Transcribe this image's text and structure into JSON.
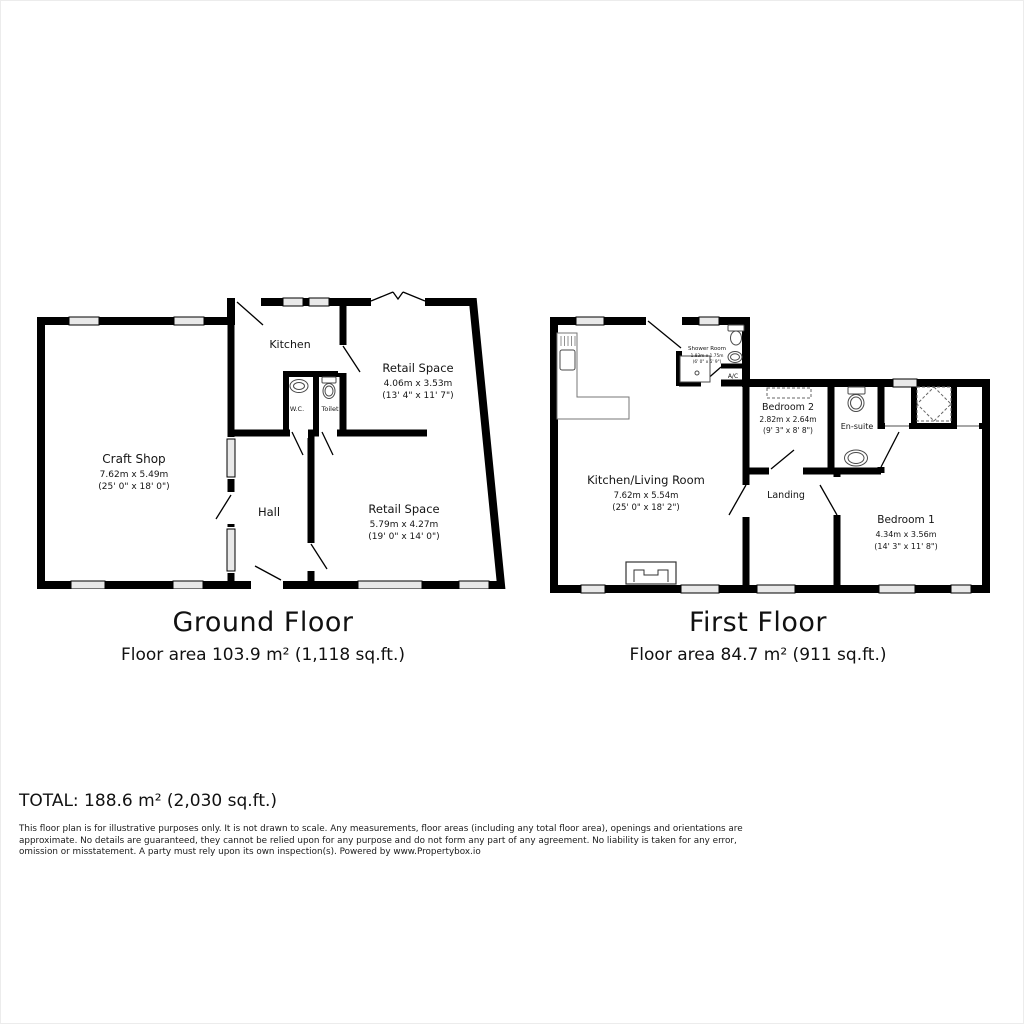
{
  "ground_floor": {
    "title": "Ground Floor",
    "area": "Floor area 103.9 m² (1,118 sq.ft.)",
    "rooms": {
      "craft_shop": {
        "name": "Craft Shop",
        "dim_m": "7.62m x 5.49m",
        "dim_ft": "(25' 0\" x 18' 0\")"
      },
      "kitchen": {
        "name": "Kitchen"
      },
      "wc": {
        "name": "W.C."
      },
      "toilet": {
        "name": "Toilet"
      },
      "retail_upper": {
        "name": "Retail Space",
        "dim_m": "4.06m x 3.53m",
        "dim_ft": "(13' 4\" x 11' 7\")"
      },
      "hall": {
        "name": "Hall"
      },
      "retail_lower": {
        "name": "Retail Space",
        "dim_m": "5.79m x 4.27m",
        "dim_ft": "(19' 0\" x 14' 0\")"
      }
    }
  },
  "first_floor": {
    "title": "First Floor",
    "area": "Floor area 84.7 m² (911 sq.ft.)",
    "rooms": {
      "kitchen_living": {
        "name": "Kitchen/Living Room",
        "dim_m": "7.62m x 5.54m",
        "dim_ft": "(25' 0\" x 18' 2\")"
      },
      "shower_room": {
        "name": "Shower Room",
        "dim_m": "1.83m x 1.75m",
        "dim_ft": "(6' 0\" x 5' 9\")"
      },
      "ac": {
        "name": "A/C"
      },
      "bedroom2": {
        "name": "Bedroom 2",
        "dim_m": "2.82m x 2.64m",
        "dim_ft": "(9' 3\" x 8' 8\")"
      },
      "ensuite": {
        "name": "En-suite"
      },
      "landing": {
        "name": "Landing"
      },
      "bedroom1": {
        "name": "Bedroom 1",
        "dim_m": "4.34m x 3.56m",
        "dim_ft": "(14' 3\" x 11' 8\")"
      }
    }
  },
  "summary": {
    "total": "TOTAL: 188.6 m² (2,030 sq.ft.)"
  },
  "disclaimer": "This floor plan is for illustrative purposes only. It is not drawn to scale. Any measurements, floor areas (including any total floor area), openings and orientations are approximate. No details are guaranteed, they cannot be relied upon for any purpose and do not form any part of any agreement. No liability is taken for any error, omission or misstatement. A party must rely upon its own inspection(s). Powered by www.Propertybox.io",
  "colors": {
    "wall": "#000000",
    "window_fill": "#e9e9e9",
    "background": "#ffffff"
  }
}
